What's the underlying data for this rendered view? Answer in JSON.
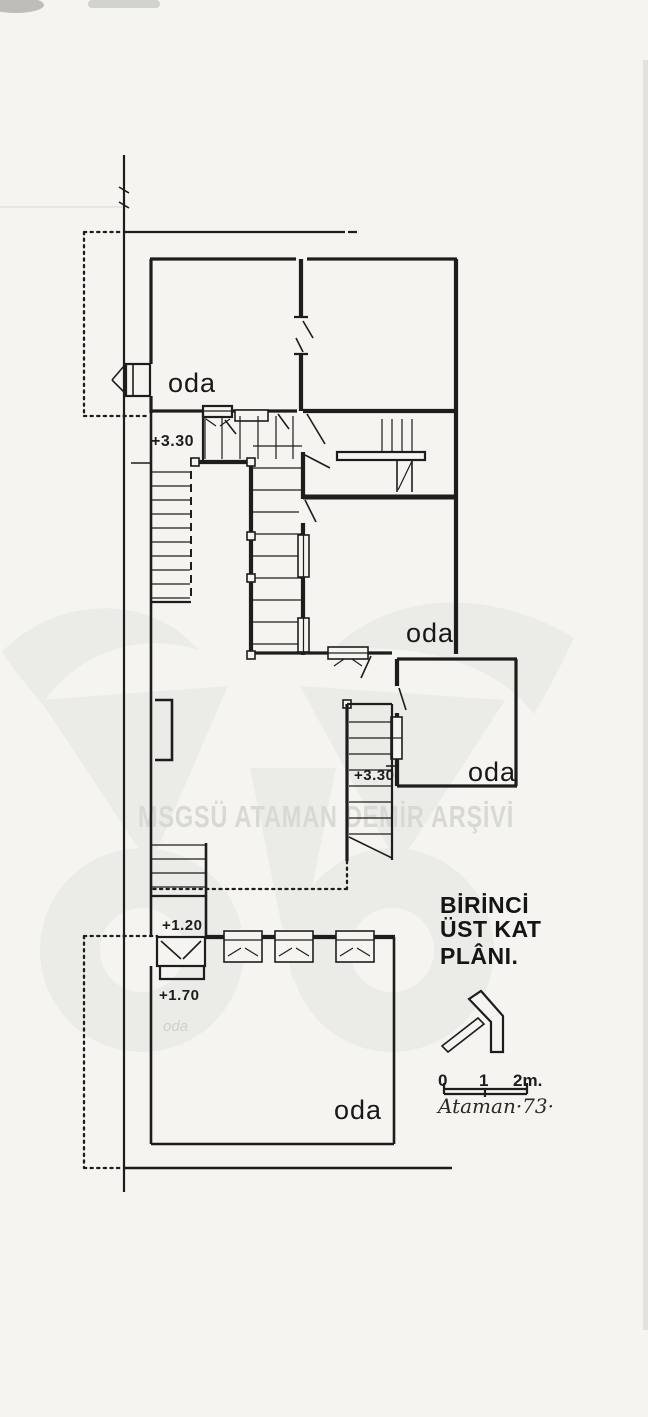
{
  "document": {
    "kind": "scanned architectural floor plan",
    "language": "Turkish"
  },
  "colors": {
    "paper": "#f5f4f1",
    "ink": "#1d1d1b",
    "watermark_logo": "#ebebe8",
    "watermark_text": "#d8d8d5"
  },
  "watermark": {
    "archive_text": "MSGSÜ ATAMAN DEMİR ARŞİVİ",
    "logo": "owl-logo"
  },
  "plan": {
    "room_labels": [
      {
        "id": "room-top-left",
        "label": "oda"
      },
      {
        "id": "room-middle",
        "label": "oda"
      },
      {
        "id": "room-right",
        "label": "oda"
      },
      {
        "id": "room-bottom",
        "label": "oda"
      }
    ],
    "elevation_marks": [
      {
        "id": "upper-stair-landing",
        "label": "+3.30"
      },
      {
        "id": "right-stair-landing",
        "label": "+3.30"
      },
      {
        "id": "left-landing",
        "label": "+1.20"
      },
      {
        "id": "entry-step",
        "label": "+1.70"
      }
    ],
    "pencil_note": "oda"
  },
  "title_block": {
    "lines": [
      "BİRİNCİ",
      "ÜST KAT",
      "PLÂNI."
    ]
  },
  "north_arrow": {
    "icon": "north-arrow-icon"
  },
  "scale_bar": {
    "ticks": [
      "0",
      "1",
      "2m."
    ]
  },
  "signature": "Ataman·73·"
}
